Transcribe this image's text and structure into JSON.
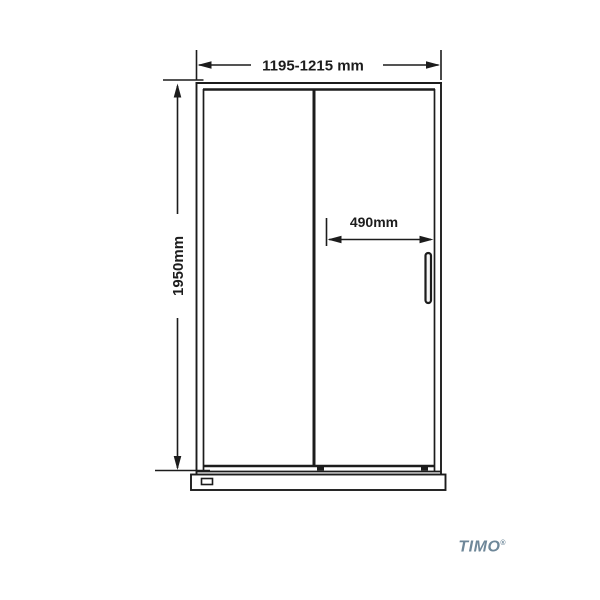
{
  "diagram": {
    "dimensions": {
      "width_label": "1195-1215 mm",
      "height_label": "1950mm",
      "opening_label": "490mm"
    },
    "logo": {
      "text": "TIMO",
      "registered": "®"
    },
    "colors": {
      "line": "#1c1c1c",
      "logo": "#6e8799",
      "background": "#ffffff"
    }
  }
}
